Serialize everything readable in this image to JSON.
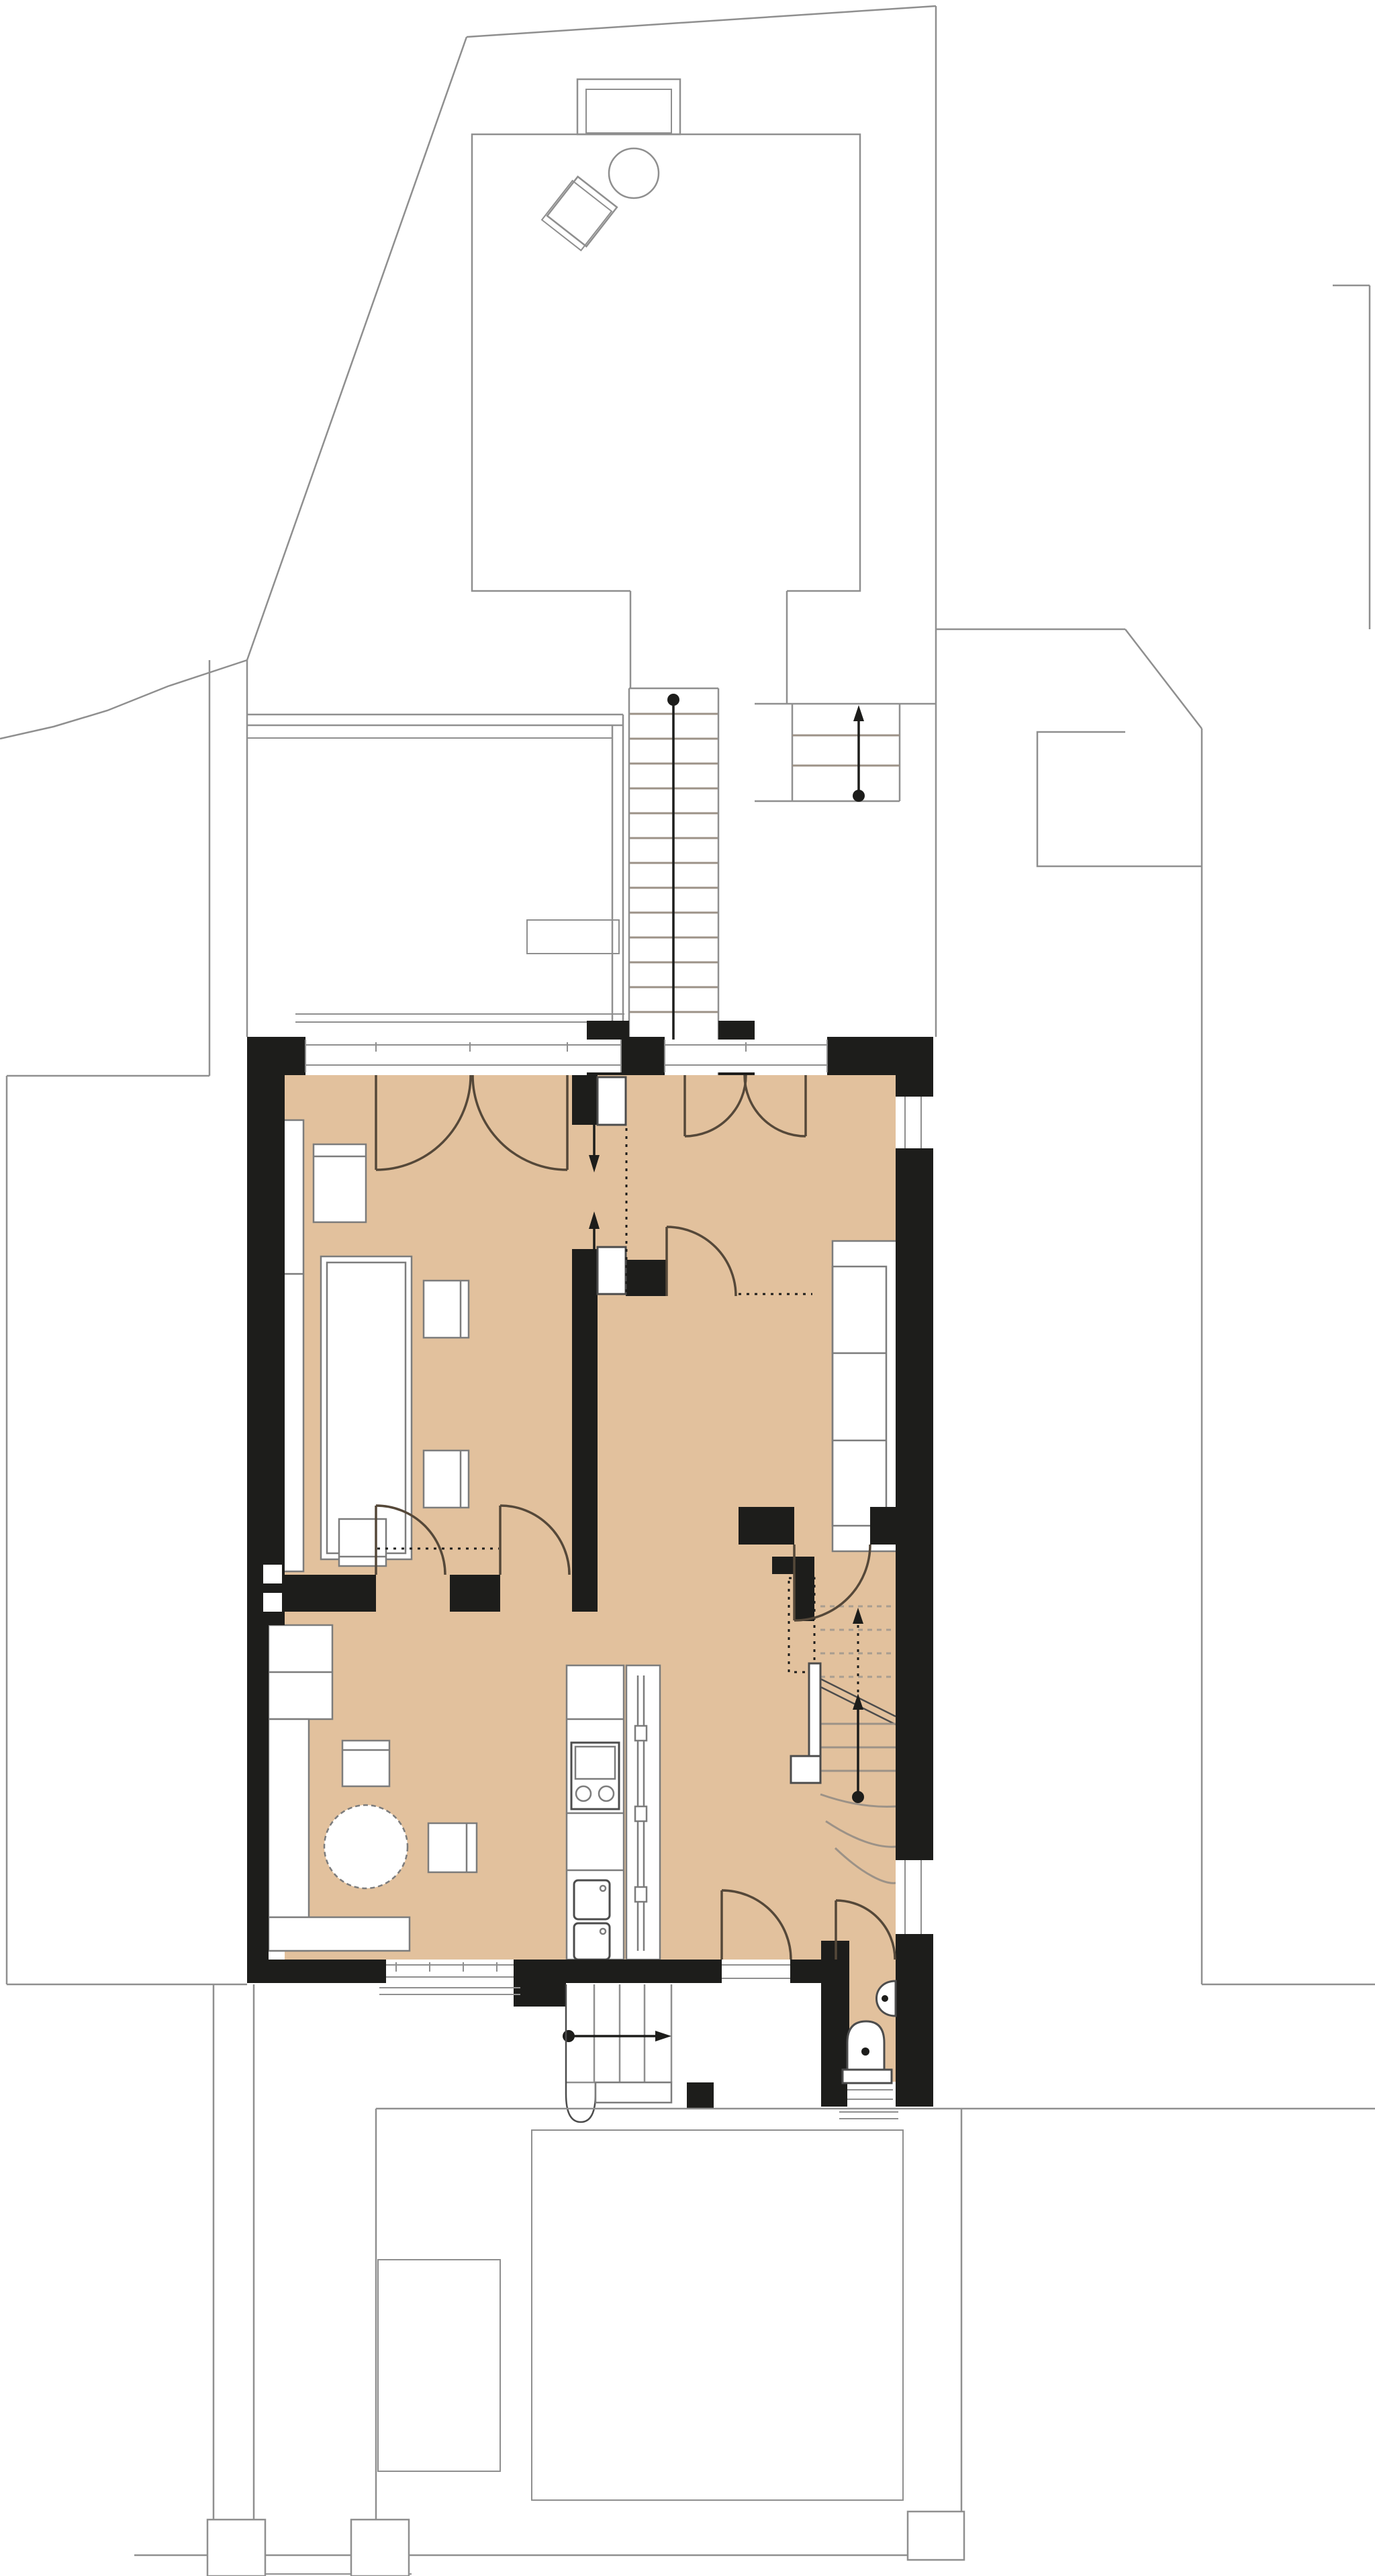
{
  "document": {
    "type": "architectural-floor-plan",
    "visible_text": [],
    "description_names": [
      "site-plan",
      "garden-pavilion",
      "rear-terrace",
      "rear-exterior-stairs",
      "main-storey",
      "dining-room",
      "living-room",
      "family-room",
      "kitchen",
      "hall",
      "interior-staircase",
      "wc",
      "entrance-steps",
      "front-yard"
    ]
  },
  "colors": {
    "background": "#ffffff",
    "site_line": "#8f8f8f",
    "wall": "#1d1d1b",
    "floor": "#e2c19d",
    "furniture_stroke": "#7c7c7c",
    "furniture_stroke_dark": "#4c4c4c",
    "glazing_line": "#8f8f8f",
    "door_stroke": "#554839",
    "tread": "#9c9287",
    "tread_dash": "#a89d90",
    "annotation": "#1d1d1b"
  },
  "stairs": {
    "rear_exterior": {
      "treads": 13,
      "arrow": "down-with-start-dot"
    },
    "garden_side_steps": {
      "treads": 2,
      "arrow": "up-with-start-dot"
    },
    "interior": {
      "upper_flight_dashed_treads": 4,
      "lower_flight_treads": 3,
      "winder_treads": 3,
      "arrows": [
        "dashed-up",
        "solid-up-with-start-dot"
      ]
    },
    "entrance": {
      "treads": 4,
      "arrow": "right-with-start-dot"
    }
  },
  "fixtures": {
    "kitchen": [
      "counter-run",
      "stove-two-burners",
      "double-sink",
      "screen-wall-with-panels"
    ],
    "wc": [
      "toilet",
      "wash-basin",
      "window"
    ],
    "dining_room": [
      "window-bay-shelf",
      "dining-table",
      "chairs"
    ],
    "living_room": [
      "sofa-three-cushions"
    ],
    "family_room": [
      "l-shaped-bench",
      "round-table",
      "chairs"
    ],
    "garden_pavilion": [
      "bay-window",
      "round-table",
      "tilted-chair"
    ]
  }
}
